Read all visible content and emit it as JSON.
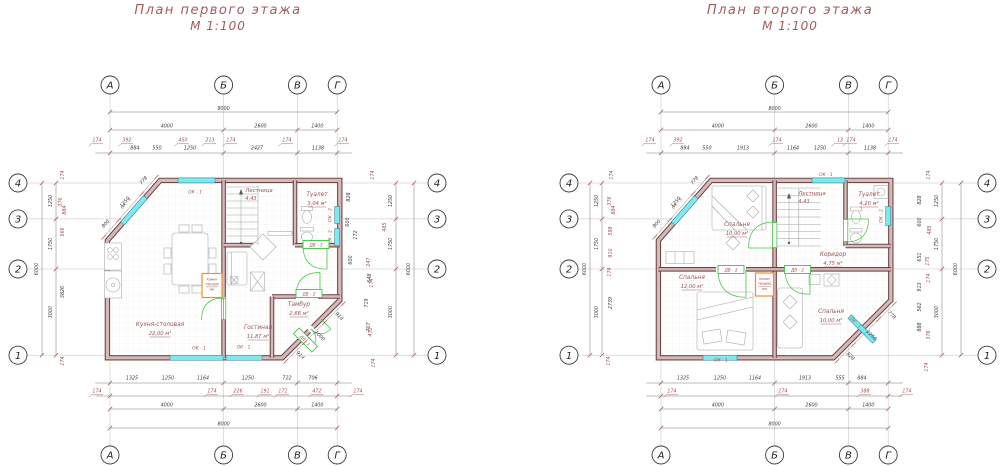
{
  "page": {
    "background": "#ffffff"
  },
  "colors": {
    "accent": "#9c5353",
    "dim": "#3c3c3c",
    "grid": "#b9b9b9",
    "wall_edge": "#6e4747",
    "wall_fill": "#d7b9b9",
    "window": "#7de9f1",
    "window_edge": "#2b7b84",
    "door": "#3fc43f",
    "fireplace": "#ef8e2a",
    "furniture": "#a3a3a3"
  },
  "plans": [
    {
      "title": "План первого этажа",
      "scale_label": "М 1:100",
      "col_axes": [
        "А",
        "Б",
        "В",
        "Г"
      ],
      "row_axes": [
        "4",
        "3",
        "2",
        "1"
      ],
      "dims": {
        "top": {
          "overall": "8000",
          "spans": [
            "4000",
            "2600",
            "1400"
          ],
          "upper": [
            "174",
            "392",
            "450",
            "213",
            "174",
            "174",
            "174"
          ],
          "lower": [
            "884",
            "550",
            "1250",
            "2427",
            "1138"
          ]
        },
        "bottom": {
          "near": [
            "1325",
            "1250",
            "1164",
            "1250",
            "722",
            "706"
          ],
          "outer": [
            "174",
            "174",
            "226",
            "191",
            "171",
            "472",
            "174"
          ],
          "spans": [
            "4000",
            "2600",
            "1400"
          ],
          "overall": "8000"
        },
        "left": {
          "spans": [
            "1250",
            "1750",
            "3000"
          ],
          "overall": "6000",
          "inner": [
            "174",
            "376",
            "884",
            "566",
            "3826",
            "174"
          ]
        },
        "right": {
          "spans": [
            "1250",
            "1750",
            "3000"
          ],
          "overall": "6000",
          "inner": [
            "828",
            "600",
            "172",
            "600",
            "648",
            "719",
            "707"
          ],
          "outer": [
            "174",
            "485",
            "247",
            "174",
            "472",
            "174"
          ]
        },
        "diag_tl": [
          "800",
          "1250",
          "778"
        ],
        "diag_br": [
          "914",
          "1000",
          "914"
        ]
      },
      "rooms": [
        {
          "name": "Кухня-столовая",
          "area": "22,00 м²"
        },
        {
          "name": "Гостиная",
          "area": "11,87 м²"
        },
        {
          "name": "Тамбур",
          "area": "2,66 м²"
        },
        {
          "name": "Туалет",
          "area": "3,04 м²"
        }
      ],
      "stairs": {
        "name": "Лестница",
        "value": "4,43"
      },
      "windows": [
        "ОК - 1",
        "ОК - 1",
        "ОК - 2",
        "ОК - 2",
        "ОК - 1",
        "ОК - 1"
      ],
      "doors": [
        "ДВ - 1",
        "ДВ - 2",
        "ДВ - 3"
      ],
      "fireplace": {
        "name": "Камин",
        "size": "790х690",
        "units": "мм"
      }
    },
    {
      "title": "План второго этажа",
      "scale_label": "М 1:100",
      "col_axes": [
        "А",
        "Б",
        "В",
        "Г"
      ],
      "row_axes": [
        "4",
        "3",
        "2",
        "1"
      ],
      "dims": {
        "top": {
          "overall": "8000",
          "spans": [
            "4000",
            "2600",
            "1400"
          ],
          "upper": [
            "174",
            "392",
            "174",
            "13",
            "174",
            "174"
          ],
          "lower": [
            "884",
            "550",
            "1913",
            "1164",
            "1250",
            "1138"
          ]
        },
        "bottom": {
          "near": [
            "1325",
            "1250",
            "1164",
            "1913",
            "555",
            "884"
          ],
          "outer": [
            "174",
            "174",
            "388",
            "174"
          ],
          "spans": [
            "4000",
            "2600",
            "1400"
          ],
          "overall": "8000"
        },
        "left": {
          "spans": [
            "1250",
            "1750",
            "3000"
          ],
          "overall": "6000",
          "inner": [
            "174",
            "376",
            "884",
            "598",
            "910",
            "174",
            "2739",
            "174"
          ]
        },
        "right": {
          "spans": [
            "1250",
            "1750",
            "3000"
          ],
          "overall": "6000",
          "inner": [
            "828",
            "600",
            "651",
            "913",
            "562",
            "888"
          ],
          "outer": [
            "174",
            "485",
            "175",
            "174",
            "376",
            "174"
          ]
        },
        "diag_tl": [
          "800",
          "1250",
          "778"
        ],
        "diag_br": [
          "778",
          "1250",
          "828"
        ]
      },
      "rooms": [
        {
          "name": "Спальня",
          "area": "10,00 м²"
        },
        {
          "name": "Туалет",
          "area": "4,20 м²"
        },
        {
          "name": "Коридор",
          "area": "4,75 м²"
        },
        {
          "name": "Спальня",
          "area": "12,00 м²"
        },
        {
          "name": "Спальня",
          "area": "10,00 м²"
        }
      ],
      "stairs": {
        "name": "Лестница",
        "value": "4,43"
      },
      "windows": [
        "ОК - 1",
        "ОК - 1",
        "ОК - 2",
        "ОК - 1",
        "ОК - 1"
      ],
      "doors": [
        "ДВ - 2",
        "ДВ - 2"
      ],
      "fireplace": {
        "name": "Камин",
        "size": "790х690",
        "units": "мм"
      }
    }
  ]
}
